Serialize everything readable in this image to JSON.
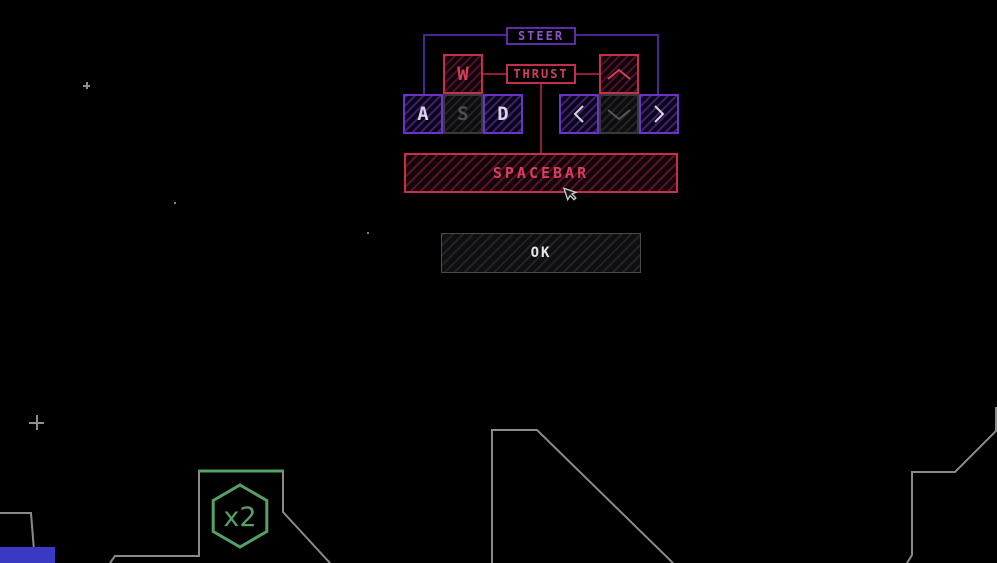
{
  "controls_overlay": {
    "steer_label": "STEER",
    "thrust_label": "THRUST",
    "keys": {
      "w": "W",
      "a": "A",
      "s": "S",
      "d": "D"
    },
    "spacebar_label": "SPACEBAR",
    "ok_label": "OK"
  },
  "hud": {
    "landing_multiplier": "x2"
  },
  "icons": {
    "up_arrow": "chevron-up",
    "down_arrow": "chevron-down",
    "left_arrow": "chevron-left",
    "right_arrow": "chevron-right",
    "pointer": "mouse-pointer"
  },
  "colors": {
    "background": "#000000",
    "purple_border": "#6a34c4",
    "purple_text": "#8b51cc",
    "red_border": "#c52f4c",
    "red_text": "#d23f58",
    "terrain": "#8a8a8a",
    "landing_pad_green": "#55a065",
    "ok_text": "#e6e6e6",
    "fuel_bar_blue": "#3939c4"
  }
}
